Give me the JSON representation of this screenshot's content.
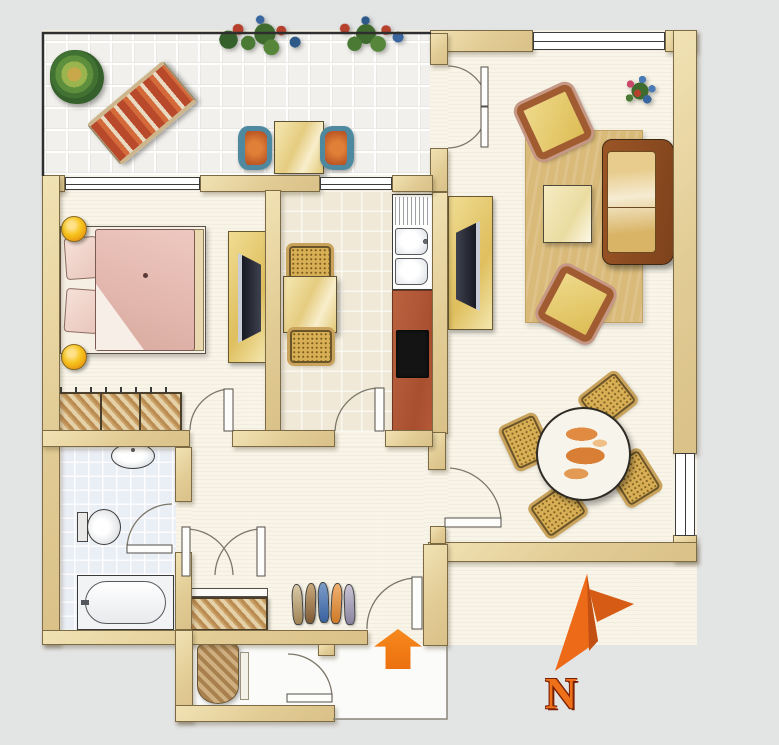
{
  "scene": {
    "type": "apartment-floor-plan",
    "description": "Hand-drawn colored floor plan of a two-room apartment with balcony, bedroom, eat-in kitchen, living room, bathroom, hallway and stair landing"
  },
  "compass": {
    "label": "N",
    "icon": "north-arrow",
    "color": "#ed6a18"
  },
  "entrance": {
    "icon": "entrance-arrow-up",
    "color": "#f07818"
  },
  "palette": {
    "background": "#e3e4e4",
    "wall": "#e9d5a0",
    "wall_edge": "#7c6b44",
    "floor_cream": "#f8f4e8",
    "balcony_tile": "#f1f0ec",
    "bath_tile": "#eaeef5",
    "kitchen_counter": "#b45a38",
    "cooktop": "#141414",
    "bed_pink": "#e5bcb4",
    "lamp_yellow": "#f5c31c",
    "rug_tan": "#d9ba79",
    "sofa_brown": "#8a4a22",
    "seat_yellow": "#e6cb63",
    "wicker": "#d9af55",
    "balcony_chair_teal": "#4e89a0",
    "accent_orange": "#f07818",
    "tv_dark": "#23232b"
  },
  "rooms": [
    {
      "name": "balcony",
      "furniture": [
        "potted-plant",
        "sun-lounger",
        "flower-box",
        "flower-box",
        "bistro-table",
        "bistro-chair",
        "bistro-chair"
      ]
    },
    {
      "name": "bedroom",
      "furniture": [
        "double-bed",
        "pillows",
        "bedside-lamp",
        "bedside-lamp",
        "wardrobe",
        "tv-stand",
        "tv"
      ]
    },
    {
      "name": "kitchen-dining",
      "furniture": [
        "small-table",
        "wicker-chair",
        "wicker-chair",
        "sink-unit",
        "counter",
        "cooktop"
      ]
    },
    {
      "name": "living-room",
      "furniture": [
        "rug",
        "sofa",
        "armchair",
        "armchair",
        "coffee-table",
        "tv-stand",
        "tv",
        "flower-bouquet",
        "round-dining-table",
        "dining-chair",
        "dining-chair",
        "dining-chair",
        "dining-chair"
      ]
    },
    {
      "name": "bathroom",
      "furniture": [
        "wash-basin",
        "toilet",
        "bathtub"
      ]
    },
    {
      "name": "hallway",
      "furniture": [
        "built-in-wardrobe",
        "shoe-row"
      ]
    },
    {
      "name": "landing",
      "furniture": [
        "rolled-mat"
      ]
    }
  ]
}
